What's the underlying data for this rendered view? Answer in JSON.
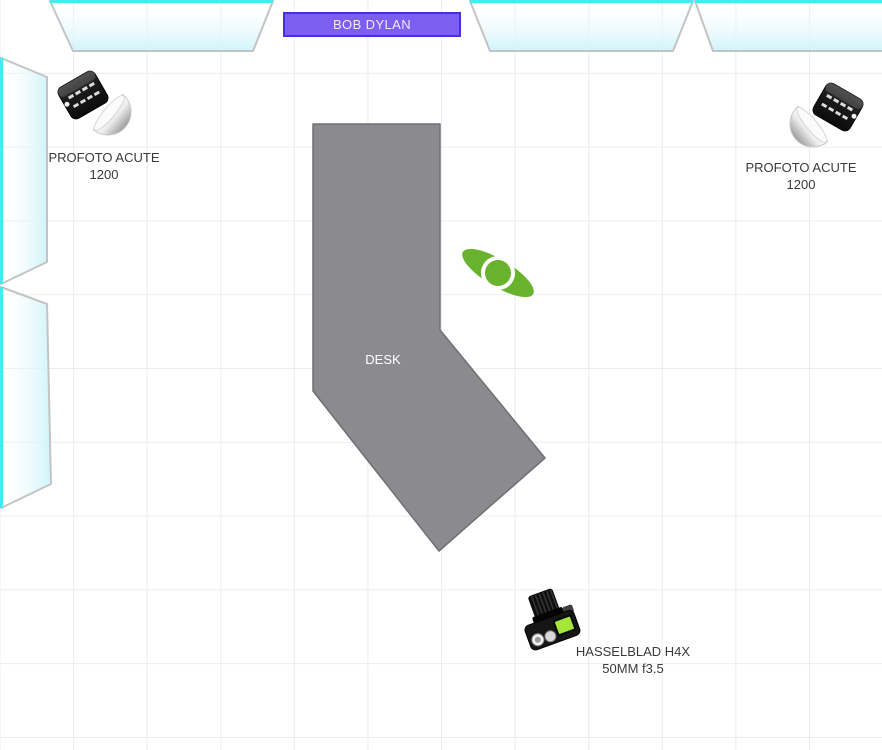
{
  "colors": {
    "accent_purple": "#7d5ef2",
    "accent_purple_border": "#4630dd",
    "title_text": "#efecff",
    "window_cyan": "#4ae8f0",
    "window_fill": "#cdf3f9",
    "wall_gray": "#c4c4c4",
    "desk_fill": "#8b8b8f",
    "desk_border": "#707074",
    "person_green": "#69b22e",
    "camera_screen_green": "#a4e63a",
    "label_text": "#3a3a3a",
    "desk_label_color": "#ffffff",
    "grid_line": "#ececec"
  },
  "scene": {
    "subject_label": "BOB DYLAN",
    "desk": {
      "label": "DESK"
    },
    "lights": [
      {
        "name": "PROFOTO ACUTE",
        "detail": "1200",
        "position": "top-left"
      },
      {
        "name": "PROFOTO ACUTE",
        "detail": "1200",
        "position": "top-right"
      }
    ],
    "camera": {
      "name": "HASSELBLAD H4X",
      "detail": "50MM f3.5",
      "position": "bottom-center"
    },
    "icons": {
      "person": "person-top-view-icon",
      "light": "strobe-head-reflector-icon",
      "camera": "camera-top-view-icon",
      "window": "window-glass-shape"
    }
  }
}
